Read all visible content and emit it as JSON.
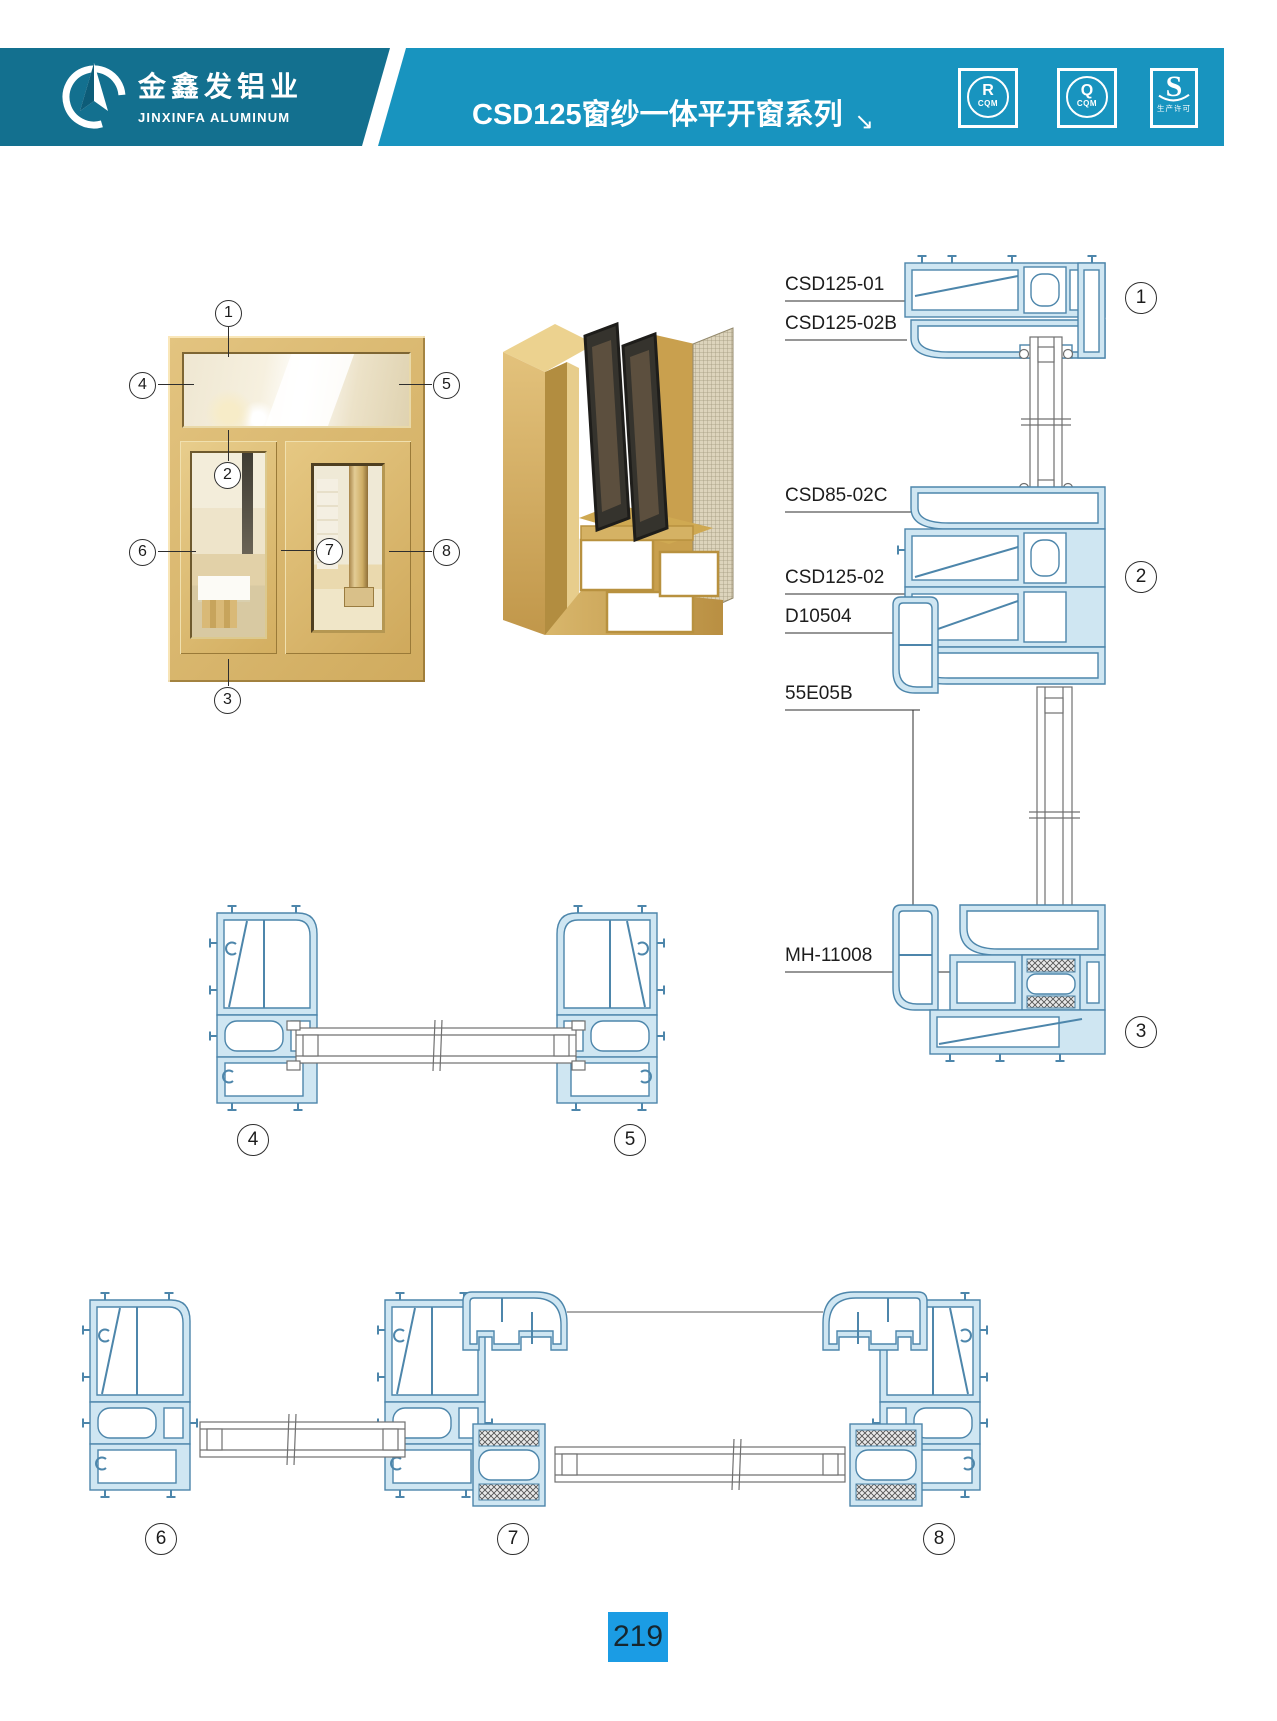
{
  "header": {
    "company_cn": "金鑫发铝业",
    "company_en": "JINXINFA ALUMINUM",
    "series_title": "CSD125窗纱一体平开窗系列",
    "arrow": "↘",
    "badges": [
      {
        "symbol": "R",
        "label": "CQM"
      },
      {
        "symbol": "Q",
        "label": "CQM"
      },
      {
        "symbol": "S",
        "label": "生产许可"
      }
    ]
  },
  "diagram": {
    "part_labels": {
      "l1": "CSD125-01",
      "l2": "CSD125-02B",
      "l3": "CSD85-02C",
      "l4": "CSD125-02",
      "l5": "D10504",
      "l6": "55E05B",
      "l7": "MH-11008"
    },
    "callouts": {
      "c1": "1",
      "c2": "2",
      "c3": "3",
      "c4": "4",
      "c5": "5",
      "c6": "6",
      "c7": "7",
      "c8": "8"
    }
  },
  "footer": {
    "page_number": "219"
  },
  "colors": {
    "brand_teal": "#13708F",
    "brand_blue": "#1894BF",
    "cad_line_blue": "#4d86ab",
    "cad_fill_blue": "#cfe6f2",
    "frame_gold": "#d8b66c",
    "page_badge_blue": "#1b9ce4"
  }
}
